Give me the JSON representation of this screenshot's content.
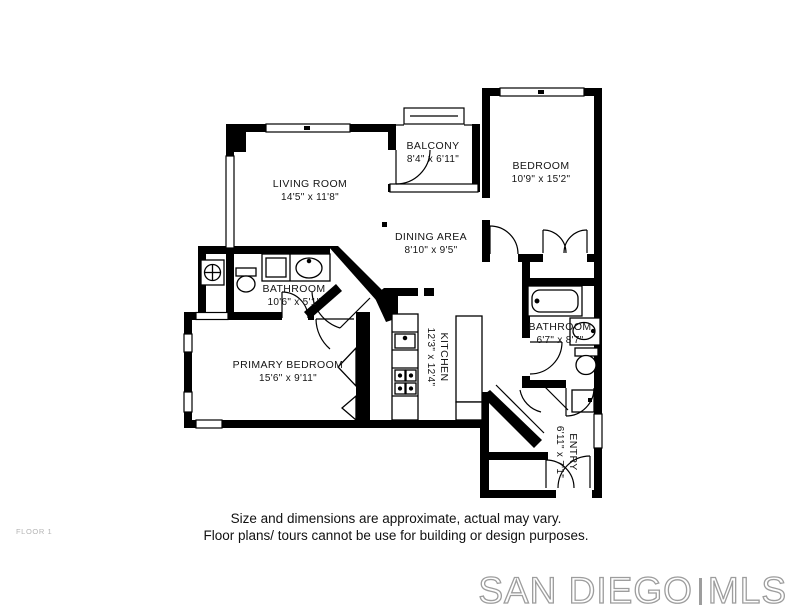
{
  "floor_plan": {
    "floor_label": "FLOOR 1",
    "rooms": [
      {
        "name": "LIVING ROOM",
        "dimensions": "14'5\" x 11'8\""
      },
      {
        "name": "BALCONY",
        "dimensions": "8'4\" x 6'11\""
      },
      {
        "name": "BEDROOM",
        "dimensions": "10'9\" x 15'2\""
      },
      {
        "name": "DINING AREA",
        "dimensions": "8'10\" x 9'5\""
      },
      {
        "name": "BATHROOM",
        "dimensions": "10'6\" x 5'1\""
      },
      {
        "name": "PRIMARY BEDROOM",
        "dimensions": "15'6\" x 9'11\""
      },
      {
        "name": "KITCHEN",
        "dimensions": "12'3\" x 12'4\""
      },
      {
        "name": "BATHROOM",
        "dimensions": "6'7\" x 8'7\""
      },
      {
        "name": "ENTRY",
        "dimensions": "6'11\" x 7'1\""
      }
    ],
    "disclaimer": {
      "line1": "Size and dimensions are approximate, actual may vary.",
      "line2": "Floor plans/ tours cannot be use for building or design purposes."
    },
    "watermark": {
      "left": "SAN DIEGO",
      "right": "MLS"
    },
    "colors": {
      "walls": "#000000",
      "text": "#141414",
      "muted": "#b4b4b4",
      "watermark": "#9d9d9d"
    }
  }
}
